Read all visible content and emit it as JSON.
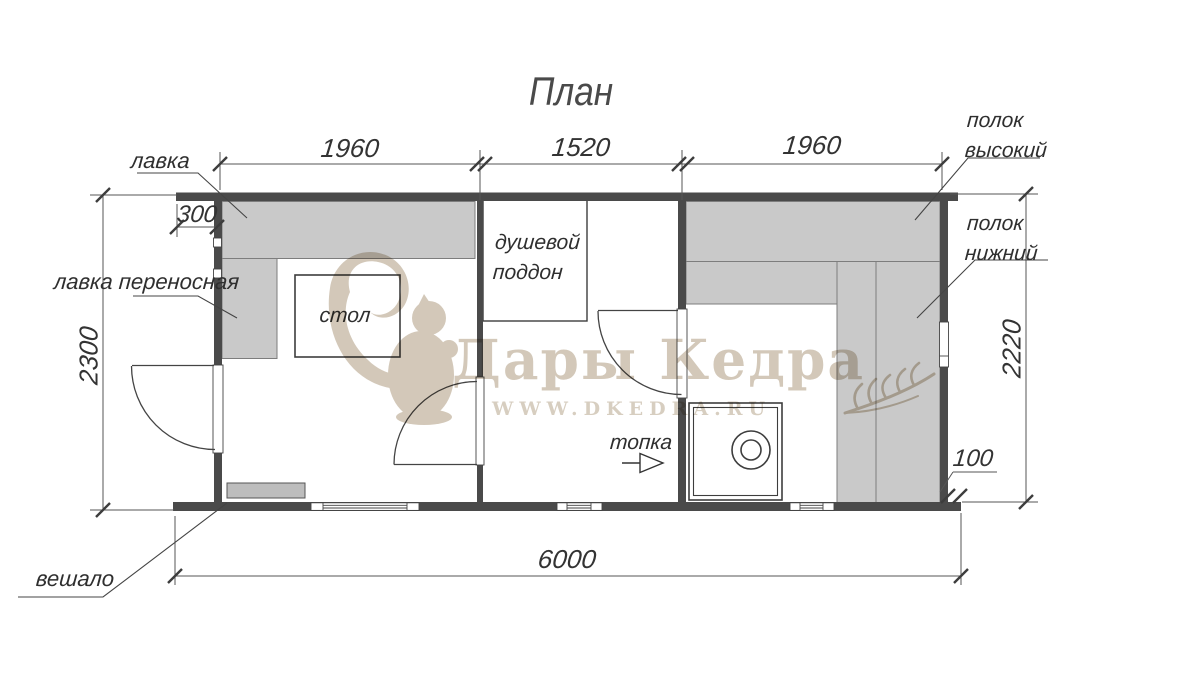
{
  "title": "План",
  "labels": {
    "bench": "лавка",
    "bench_portable": "лавка переносная",
    "table": "стол",
    "shower_tray": "душевой поддон",
    "firebox": "топка",
    "shelf_high": "полок высокий",
    "shelf_low": "полок нижний",
    "hanger": "вешало"
  },
  "dimensions": {
    "top_left_room_width": "1960",
    "top_middle_room_width": "1520",
    "top_right_room_width": "1960",
    "top_overhang": "300",
    "left_height": "2300",
    "right_height": "2220",
    "bottom_total_width": "6000",
    "bottom_right_offset": "100"
  },
  "watermark": {
    "brand": "Дары Кедра",
    "url": "WWW.DKEDRA.RU"
  },
  "colors": {
    "wall": "#4a4a4a",
    "bench_fill": "#c9c9c9",
    "line": "#3d3d3d",
    "watermark_tan": "#cfc4b3"
  }
}
